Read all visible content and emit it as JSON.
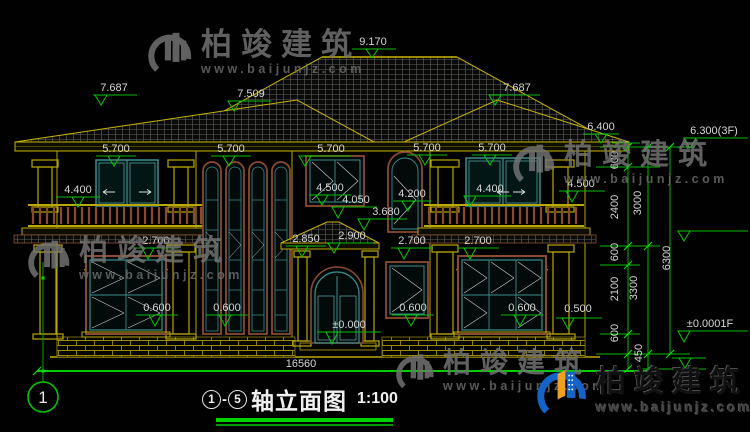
{
  "title_block": {
    "axis_from": "1",
    "sep": "-",
    "axis_to": "5",
    "name": "轴立面图",
    "scale": "1:100"
  },
  "axis_bubble": {
    "label": "1"
  },
  "watermark": {
    "name": "柏竣建筑",
    "url": "www.baijunjz.com"
  },
  "brand": {
    "name": "柏竣建筑",
    "url": "www.baijunjz.com"
  },
  "colors": {
    "background": "#010102",
    "cad_yellow": "#b9a800",
    "dim_green": "#00bb00",
    "bright_green": "#00e000",
    "text_white": "#d6d6d6",
    "window_teal": "#3d8c8c",
    "frame_brown": "#8a4a30",
    "brand_blue": "#1464c8",
    "brand_orange": "#f0a01e",
    "watermark_gray": "#757575"
  },
  "annotations": [
    {
      "t": "9.170",
      "x": 373,
      "y": 45
    },
    {
      "t": "7.687",
      "x": 114,
      "y": 91
    },
    {
      "t": "7.509",
      "x": 251,
      "y": 97
    },
    {
      "t": "7.687",
      "x": 517,
      "y": 91
    },
    {
      "t": "6.400",
      "x": 601,
      "y": 130
    },
    {
      "t": "6.300(3F)",
      "x": 714,
      "y": 134
    },
    {
      "t": "5.700",
      "x": 116,
      "y": 152
    },
    {
      "t": "5.700",
      "x": 231,
      "y": 152
    },
    {
      "t": "5.700",
      "x": 331,
      "y": 152
    },
    {
      "t": "5.700",
      "x": 427,
      "y": 151
    },
    {
      "t": "5.700",
      "x": 492,
      "y": 151
    },
    {
      "t": "4.400",
      "x": 78,
      "y": 193
    },
    {
      "t": "4.500",
      "x": 330,
      "y": 191
    },
    {
      "t": "4.050",
      "x": 356,
      "y": 203
    },
    {
      "t": "4.200",
      "x": 412,
      "y": 197
    },
    {
      "t": "3.680",
      "x": 386,
      "y": 215
    },
    {
      "t": "4.400",
      "x": 490,
      "y": 192
    },
    {
      "t": "4.500",
      "x": 581,
      "y": 187
    },
    {
      "t": "2.850",
      "x": 306,
      "y": 242
    },
    {
      "t": "2.900",
      "x": 352,
      "y": 239
    },
    {
      "t": "2.700",
      "x": 156,
      "y": 244
    },
    {
      "t": "2.700",
      "x": 412,
      "y": 244
    },
    {
      "t": "2.700",
      "x": 478,
      "y": 244
    },
    {
      "t": "0.600",
      "x": 157,
      "y": 311
    },
    {
      "t": "0.600",
      "x": 227,
      "y": 311
    },
    {
      "t": "0.600",
      "x": 413,
      "y": 311
    },
    {
      "t": "0.600",
      "x": 522,
      "y": 311
    },
    {
      "t": "0.500",
      "x": 578,
      "y": 312
    },
    {
      "t": "±0.000",
      "x": 349,
      "y": 328
    },
    {
      "t": "±0.0001F",
      "x": 710,
      "y": 327
    },
    {
      "t": "16560",
      "x": 301,
      "y": 367
    },
    {
      "t": "600",
      "x": 618,
      "y": 160,
      "rot": 1
    },
    {
      "t": "2400",
      "x": 618,
      "y": 207,
      "rot": 1
    },
    {
      "t": "600",
      "x": 618,
      "y": 252,
      "rot": 1
    },
    {
      "t": "2100",
      "x": 618,
      "y": 289,
      "rot": 1
    },
    {
      "t": "600",
      "x": 618,
      "y": 333,
      "rot": 1
    },
    {
      "t": "3000",
      "x": 641,
      "y": 203,
      "rot": 1
    },
    {
      "t": "3300",
      "x": 637,
      "y": 288,
      "rot": 1
    },
    {
      "t": "450",
      "x": 642,
      "y": 353,
      "rot": 1
    },
    {
      "t": "6300",
      "x": 670,
      "y": 258,
      "rot": 1
    }
  ]
}
